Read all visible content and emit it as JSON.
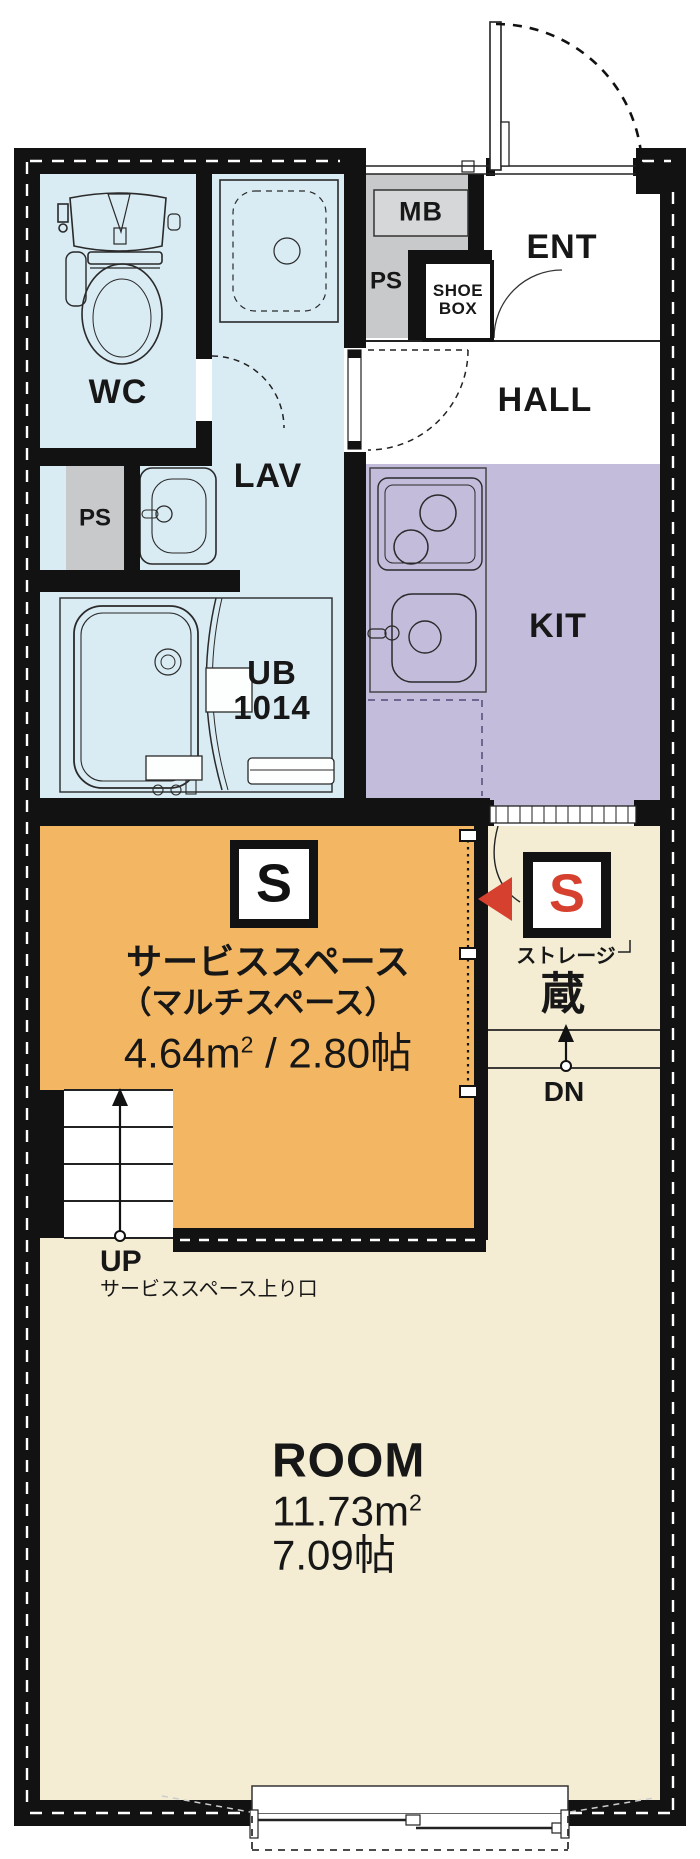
{
  "colors": {
    "wall_black": "#121212",
    "water_blue": "#d9ebf3",
    "kitchen_purple": "#c3bcdb",
    "service_orange": "#f3b763",
    "room_cream": "#f4edd3",
    "ps_gray": "#c8c9cb",
    "mb_box_gray": "#d5d7d9",
    "accent_red": "#d6402e"
  },
  "icons": [
    "toilet-icon",
    "shower-stall-icon",
    "washbasin-icon",
    "bathtub-icon",
    "mirror-icon",
    "stove-icon",
    "kitchen-sink-icon",
    "fridge-space-dashed-icon",
    "entrance-door-icon",
    "door-swing-icon",
    "stairs-icon",
    "up-arrow-icon",
    "down-arrow-icon",
    "storage-entry-arrow-icon",
    "sliding-window-icon",
    "balcony-outline-icon"
  ],
  "rooms": {
    "wc": {
      "label": "WC"
    },
    "lav": {
      "label": "LAV"
    },
    "ps_left": {
      "label": "PS"
    },
    "mb": {
      "label": "MB"
    },
    "ps_right": {
      "label": "PS"
    },
    "shoe_box": {
      "line1": "SHOE",
      "line2": "BOX"
    },
    "ent": {
      "label": "ENT"
    },
    "hall": {
      "label": "HALL"
    },
    "kit": {
      "label": "KIT"
    },
    "ub": {
      "line1": "UB",
      "line2": "1014"
    },
    "service": {
      "marker": "S",
      "name": "サービススペース",
      "alt_name": "（マルチスペース）",
      "area_m": "4.64m",
      "area_sup": "2",
      "area_rest": " / 2.80帖"
    },
    "storage": {
      "marker": "S",
      "label": "ストレージ",
      "kanji": "蔵"
    },
    "stairs_down": {
      "label": "DN"
    },
    "stairs_up": {
      "label": "UP",
      "note": "サービススペース上り口"
    },
    "room": {
      "label": "ROOM",
      "area_m": "11.73m",
      "area_sup": "2",
      "tatami": "7.09帖"
    }
  }
}
